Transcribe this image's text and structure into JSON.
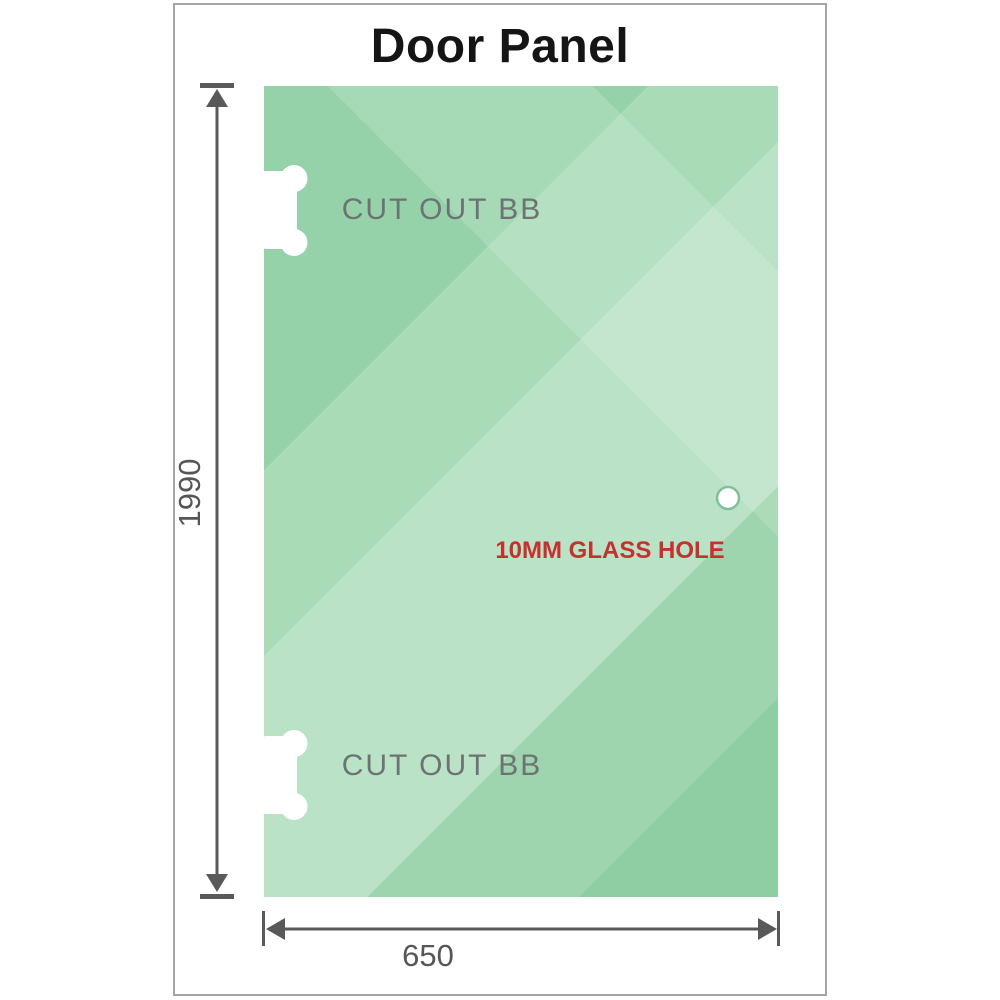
{
  "title": "Door Panel",
  "panel": {
    "top_cutout_label": "CUT OUT BB",
    "bottom_cutout_label": "CUT OUT BB",
    "hole_label": "10MM GLASS HOLE"
  },
  "dimensions": {
    "height": "1990",
    "width": "650"
  },
  "colors": {
    "glass_base": "#96d2a9",
    "glass_light_band": "#bae2c6",
    "dimension_gray": "#595959",
    "cutout_label_gray": "#6d7272",
    "hole_label_red": "#c5312e",
    "title_black": "#151515",
    "frame_border": "#a5a5a5"
  }
}
